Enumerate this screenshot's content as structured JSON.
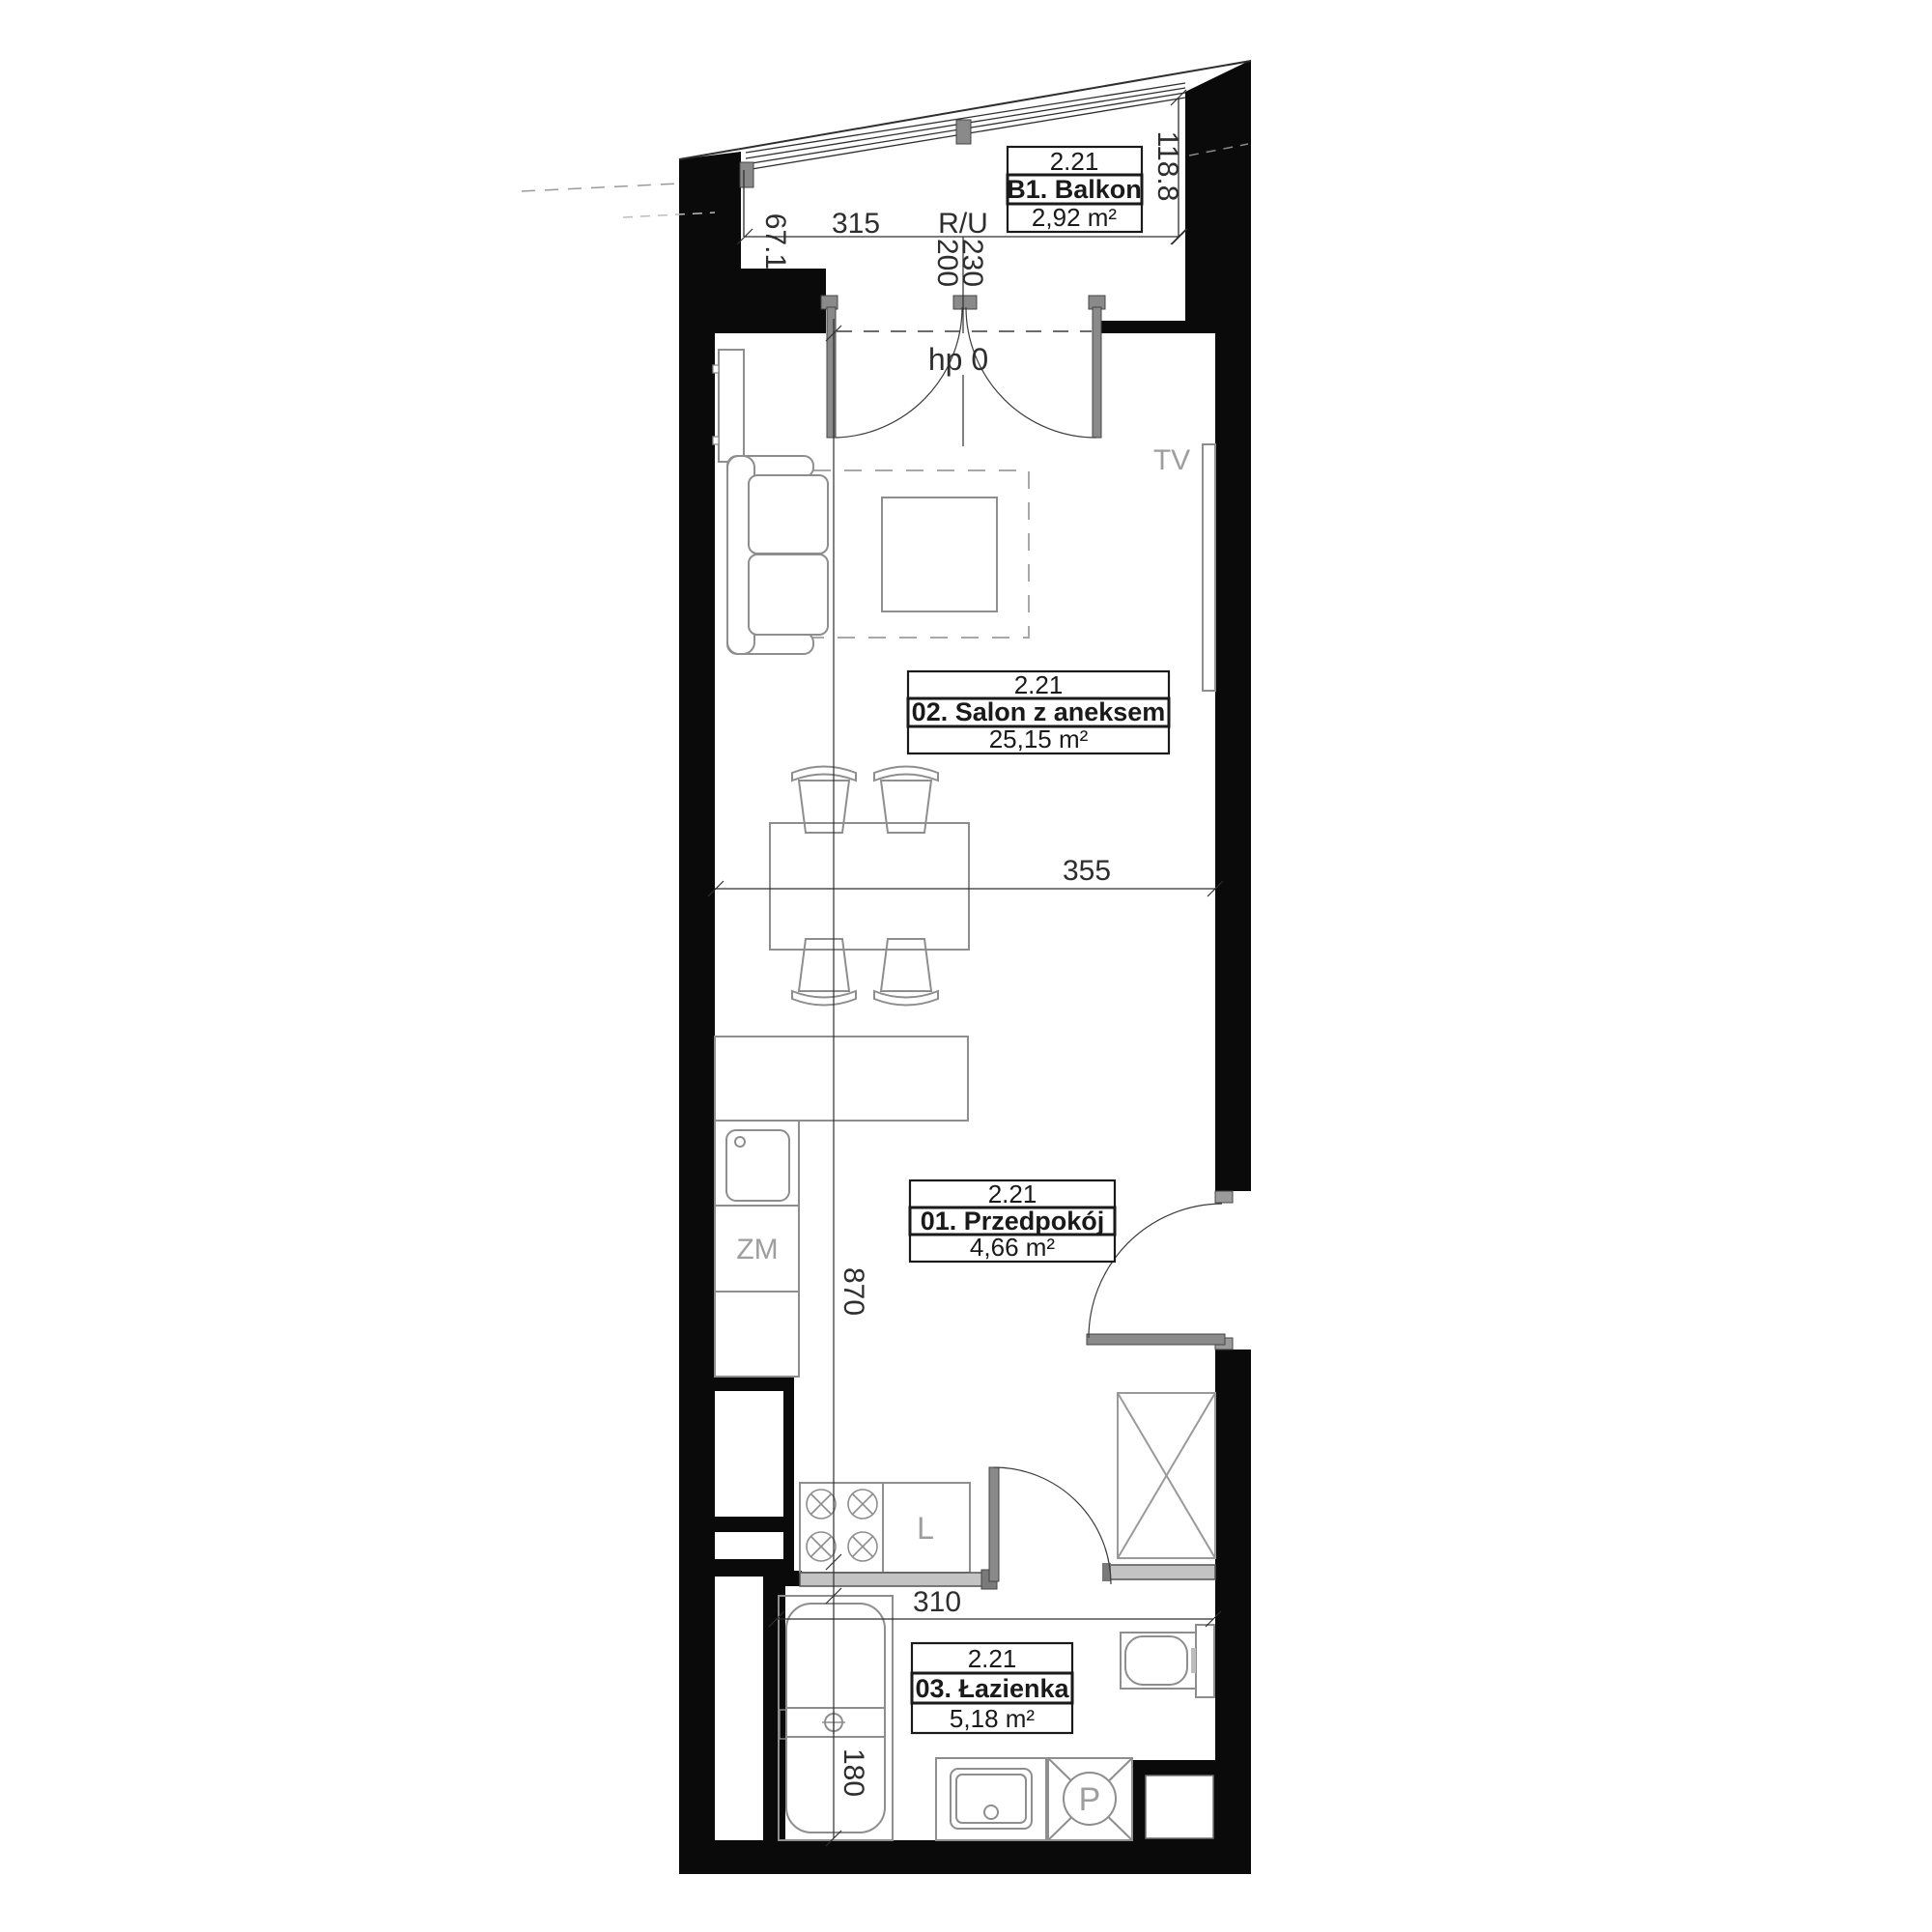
{
  "plan": {
    "rooms": {
      "balkon": {
        "unit": "2.21",
        "name": "B1. Balkon",
        "area": "2,92 m²"
      },
      "salon": {
        "unit": "2.21",
        "name": "02. Salon z aneksem",
        "area": "25,15 m²"
      },
      "przedpokoj": {
        "unit": "2.21",
        "name": "01. Przedpokój",
        "area": "4,66 m²"
      },
      "lazienka": {
        "unit": "2.21",
        "name": "03. Łazienka",
        "area": "5,18 m²"
      }
    },
    "dimensions": {
      "balcony_width": "315",
      "balcony_edge_left": "67.1",
      "balcony_edge_right": "118.8",
      "dim_200": "200",
      "dim_230": "230",
      "sill_height": "hp 0",
      "living_width": "355",
      "apartment_length": "870",
      "bathroom_width": "310",
      "bathtub_length": "180"
    },
    "fixtures": {
      "tv": "TV",
      "dishwasher": "ZM",
      "fridge": "L",
      "shower": "P",
      "balcony_note": "R/U"
    },
    "colors": {
      "wall": "#0a0a0a",
      "furniture": "#8e8e8e",
      "dimension": "#2e2e2e",
      "muted_label": "#9e9e9e",
      "threshold": "#c3c3c3",
      "door_leaf": "#8a8a8a"
    }
  }
}
